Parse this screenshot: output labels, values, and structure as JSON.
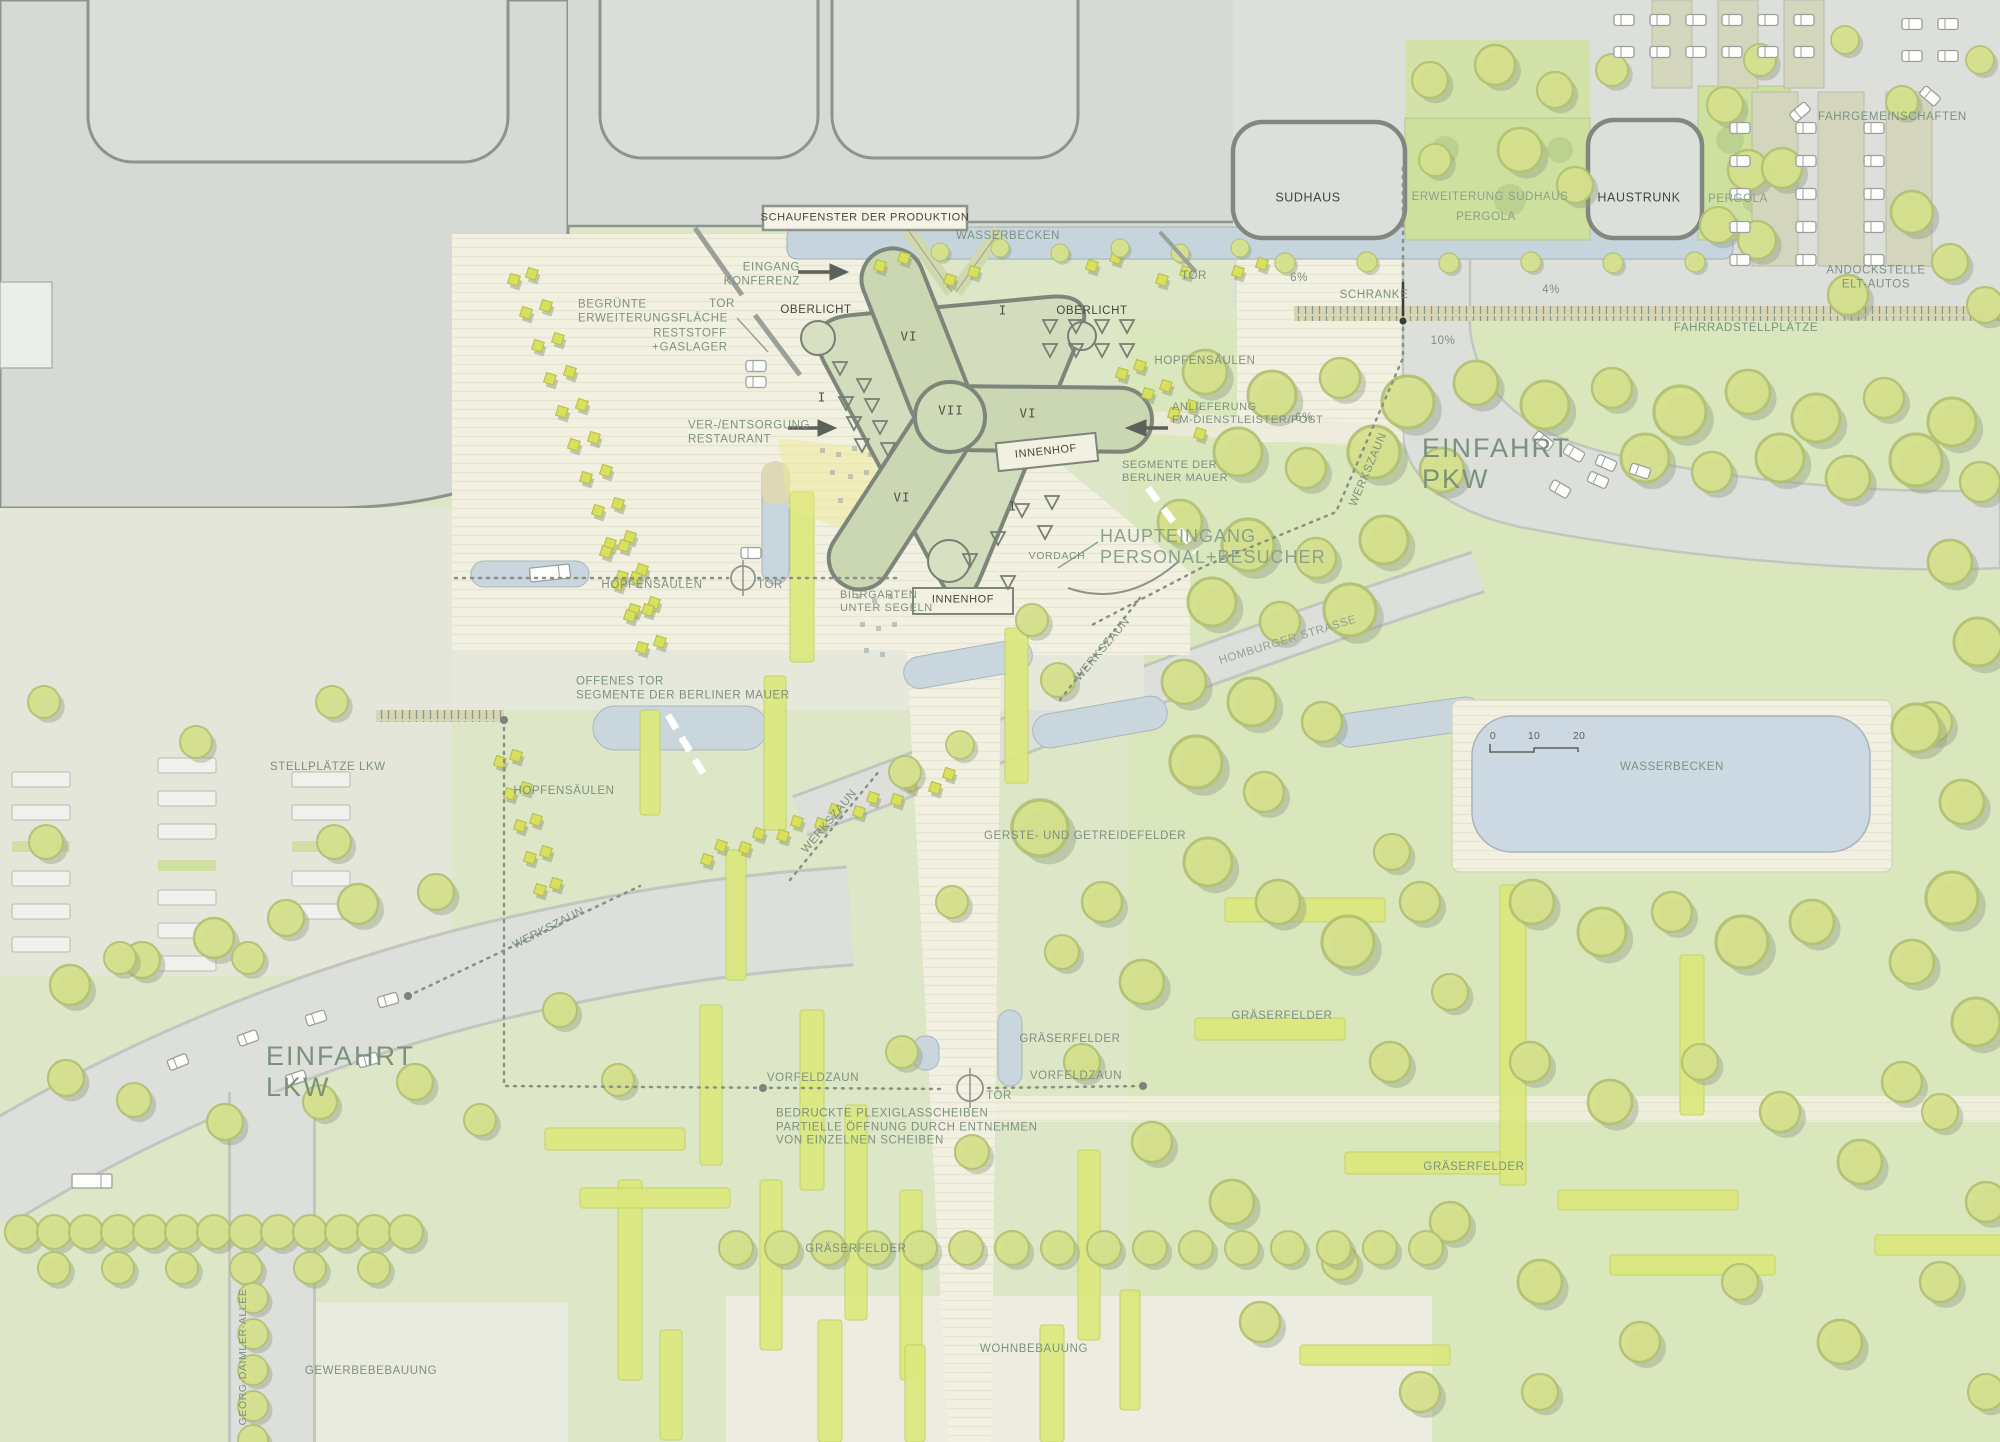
{
  "palette": {
    "vegetation_base": "#dde6c6",
    "vegetation_right": "#d9e5ba",
    "gray_building": "#d7dad4",
    "paving_ivory": "#f2f1e1",
    "water": "#c6d4de",
    "building_green": "#cdd8b4",
    "grass_strip": "#dce97e",
    "label_green": "#7d9180",
    "label_dark": "#41463f"
  },
  "labels": {
    "schaufenster": "SCHAUFENSTER DER PRODUKTION",
    "wasserbecken_top": "WASSERBECKEN",
    "eingang_konferenz": "EINGANG\nKONFERENZ",
    "tor_nw": "TOR",
    "tor_ne": "TOR",
    "tor_mid": "TOR",
    "tor_low": "TOR",
    "reststoff": "RESTSTOFF\n+GASLAGER",
    "begruente": "BEGRÜNTE\nERWEITERUNGSFLÄCHE",
    "oberlicht_links": "OBERLICHT",
    "oberlicht_rechts": "OBERLICHT",
    "vi_oben": "VI",
    "vi_rechts": "VI",
    "vi_unten": "VI",
    "vii": "VII",
    "i_links": "I",
    "i_oben": "I",
    "i_unten": "I",
    "innenhof_oben": "INNENHOF",
    "innenhof_unten": "INNENHOF",
    "ver_entsorgung": "VER-/ENTSORGUNG\nRESTAURANT",
    "anlieferung": "ANLIEFERUNG\nFM-DIENSTLEISTER/POST",
    "segmente_eingang": "SEGMENTE DER\nBERLINER MAUER",
    "haupteingang": "HAUPTEINGANG\nPERSONAL+BESUCHER",
    "vordach": "VORDACH",
    "biergarten": "BIERGARTEN\nUNTER SEGELN",
    "hopfensaeulen_oben": "HOPFENSÄULEN",
    "hopfensaeulen_mitte": "HOPFENSÄULEN",
    "hopfensaeulen_unten": "HOPFENSÄULEN",
    "offenes_tor": "OFFENES TOR\nSEGMENTE DER BERLINER MAUER",
    "stellplaetze_lkw": "STELLPLÄTZE LKW",
    "einfahrt_pkw": "EINFAHRT\nPKW",
    "einfahrt_lkw": "EINFAHRT\nLKW",
    "schranke": "SCHRANKE",
    "pct6_a": "6%",
    "pct4": "4%",
    "pct10": "10%",
    "pct6_b": "6%",
    "fahrgemeinschaften": "FAHRGEMEINSCHAFTEN",
    "andockstelle": "ANDOCKSTELLE ELT-AUTOS",
    "fahrradstellplaetze": "FAHRRADSTELLPLÄTZE",
    "sudhaus": "SUDHAUS",
    "haustrunk": "HAUSTRUNK",
    "erweiterung_sudhaus": "ERWEITERUNG SUDHAUS",
    "pergola_a": "PERGOLA",
    "pergola_b": "PERGOLA",
    "werkszaun_1": "WERKSZAUN",
    "werkszaun_2": "WERKSZAUN",
    "werkszaun_3": "WERKSZAUN",
    "werkszaun_4": "WERKSZAUN",
    "homburger_strasse": "HOMBURGER STRASSE",
    "gerste": "GERSTE- UND GETREIDEFELDER",
    "graeserfelder_1": "GRÄSERFELDER",
    "graeserfelder_2": "GRÄSERFELDER",
    "graeserfelder_3": "GRÄSERFELDER",
    "graeserfelder_4": "GRÄSERFELDER",
    "vorfeldzaun_links": "VORFELDZAUN",
    "vorfeldzaun_rechts": "VORFELDZAUN",
    "bedruckte": "BEDRUCKTE PLEXIGLASSCHEIBEN\nPARTIELLE ÖFFNUNG DURCH ENTNEHMEN\nVON EINZELNEN SCHEIBEN",
    "georg_daimler": "GEORG-DAIMLER-ALLEE",
    "gewerbe": "GEWERBEBEBAUUNG",
    "wohn": "WOHNBEBAUUNG",
    "wasserbecken_pool": "WASSERBECKEN",
    "scale_0": "0",
    "scale_10": "10",
    "scale_20": "20"
  }
}
